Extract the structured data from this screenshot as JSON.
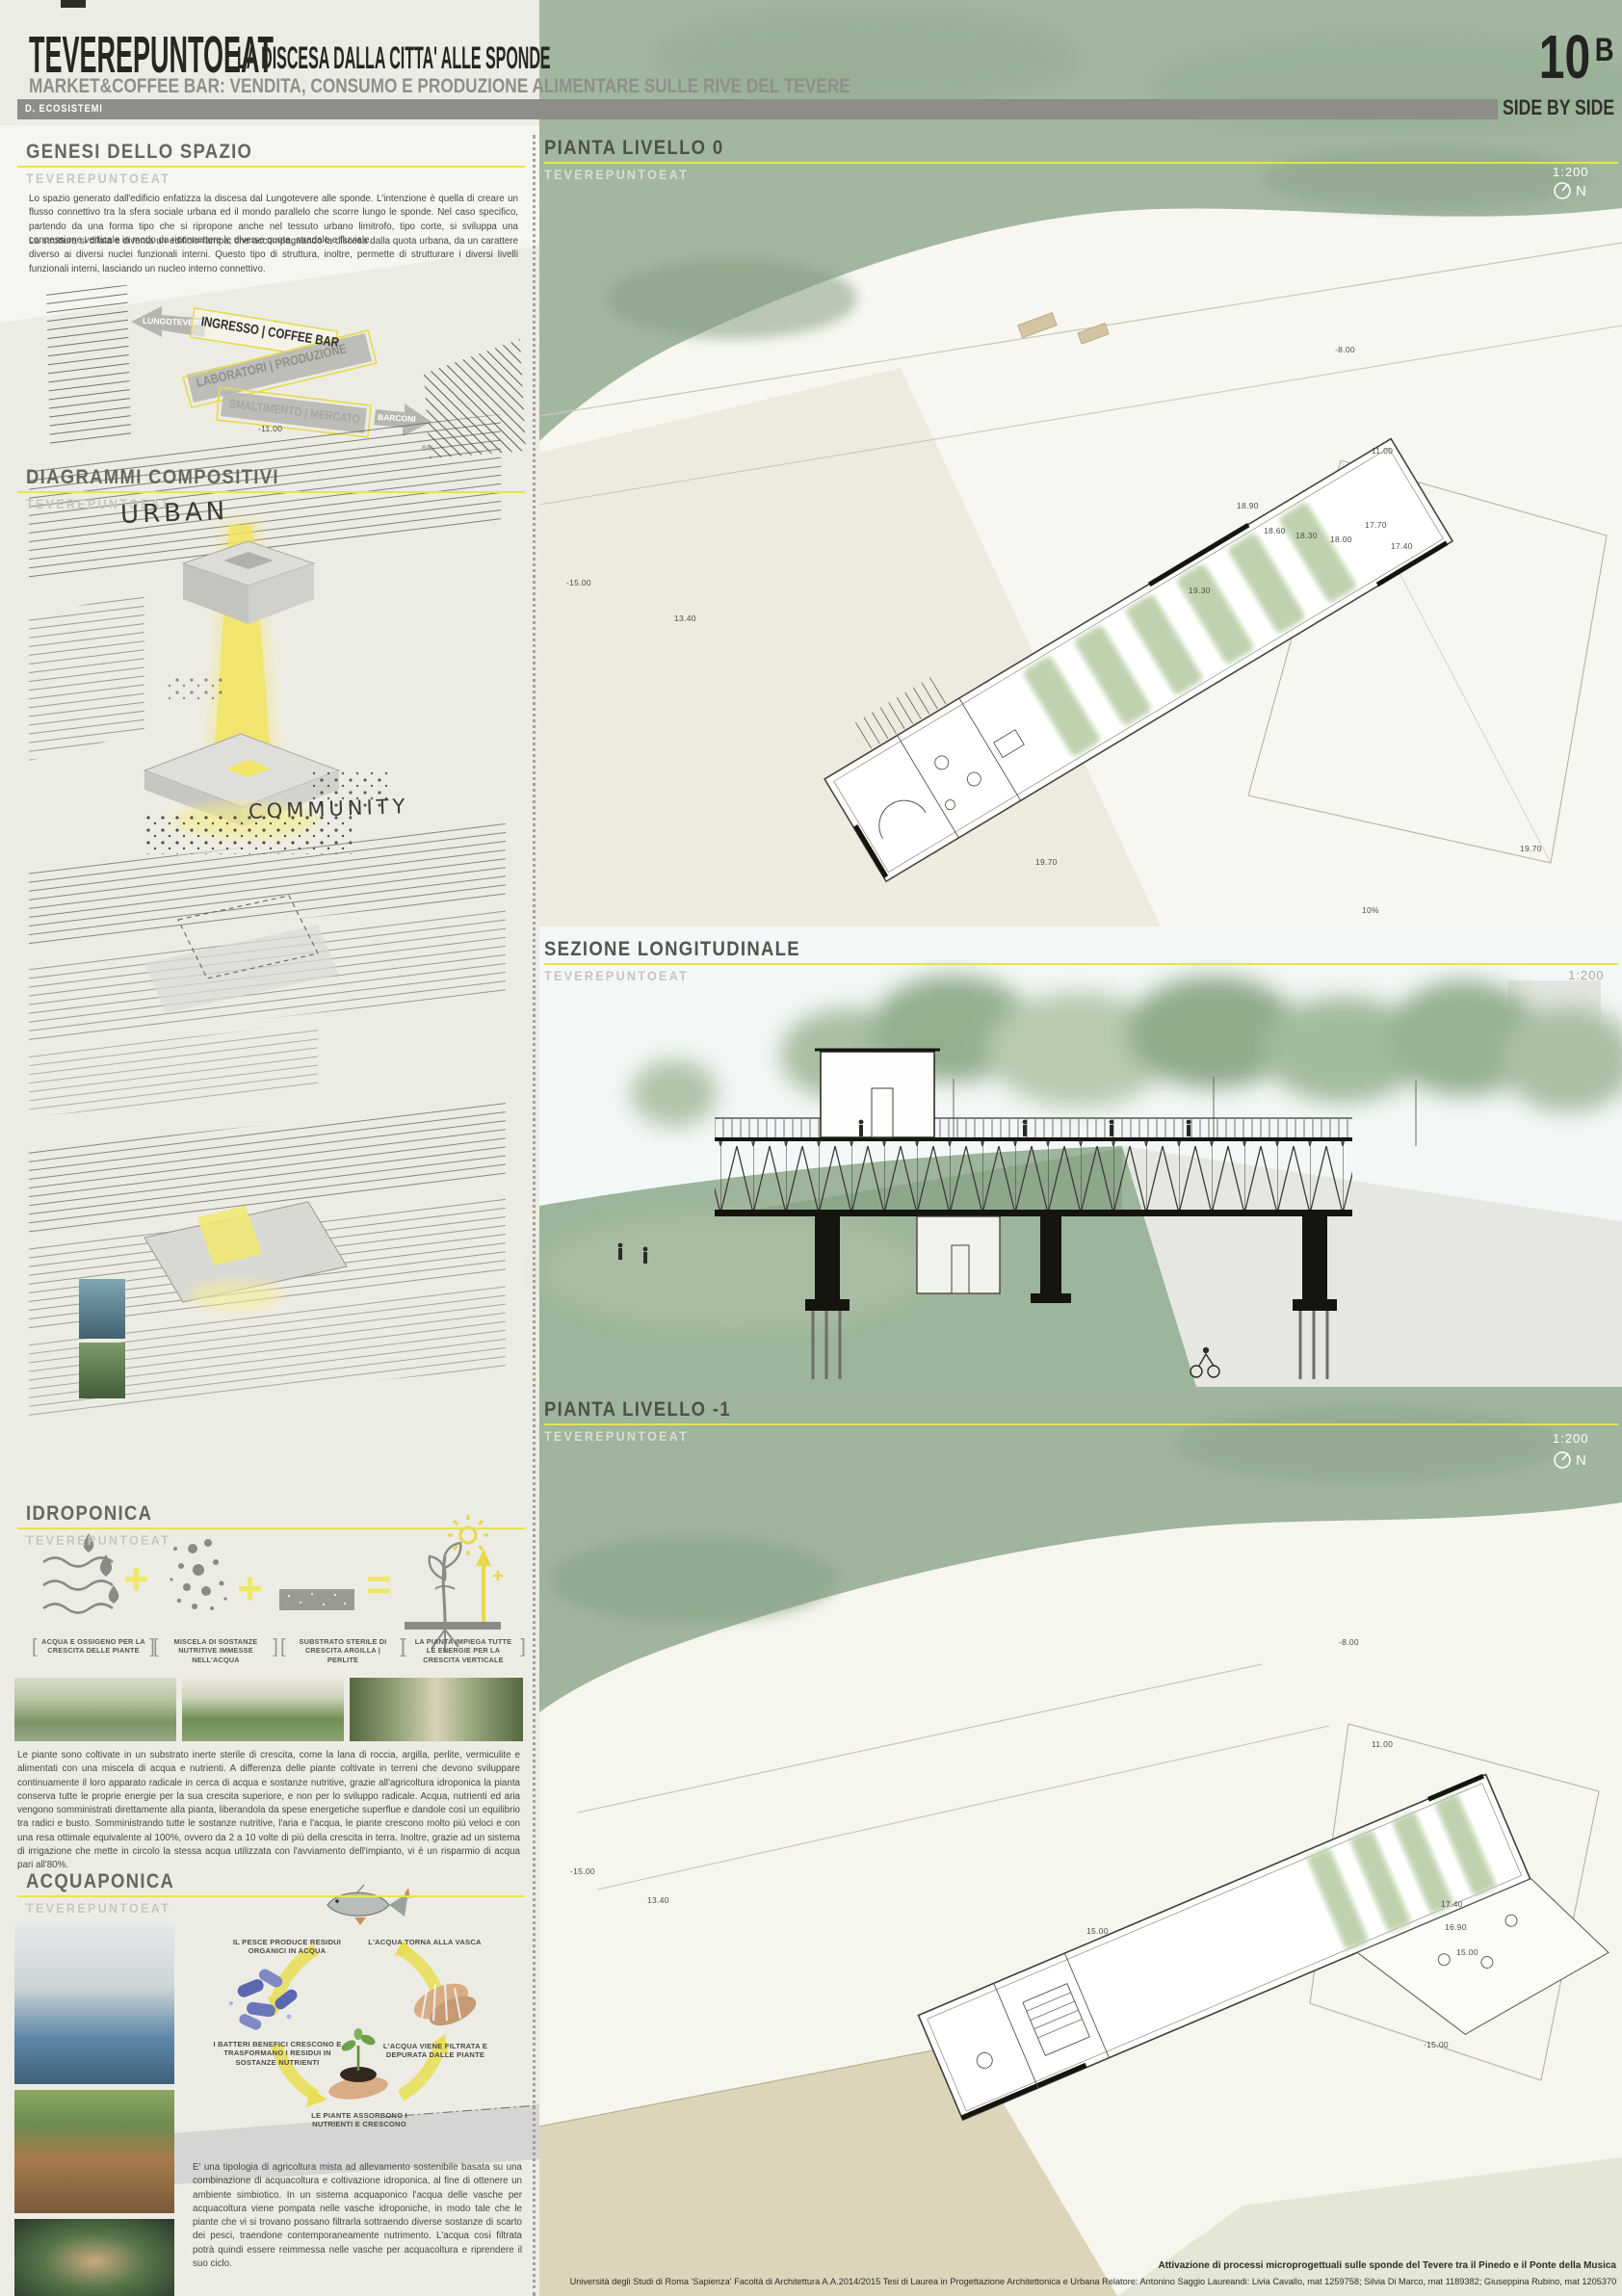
{
  "brand": "TEVEREPUNTOEAT",
  "header": {
    "title": "TEVEREPUNTOEAT",
    "subtitle": "LA DISCESA DALLA CITTA' ALLE SPONDE",
    "tagline": "MARKET&COFFEE BAR: VENDITA, CONSUMO E PRODUZIONE ALIMENTARE SULLE RIVE DEL TEVERE",
    "series_label": "D. ECOSISTEMI",
    "board_number": "10",
    "board_suffix": "B",
    "board_motto": "SIDE BY SIDE"
  },
  "genesi": {
    "title": "GENESI DELLO SPAZIO",
    "body1": "Lo spazio generato dall'edificio enfatizza la discesa dal Lungotevere alle sponde. L'intenzione è quella di creare un flusso connettivo tra la sfera sociale urbana ed il mondo parallelo che scorre lungo le sponde. Nel caso specifico, partendo da una forma tipo che si ripropone anche nel tessuto urbano limitrofo, tipo corte, si sviluppa una connessione verticale in modo da riconnettere le diverse quote, stradale e fluviale.",
    "body2": "La struttura si dilata e diventa un edificio-rampa, che accompagnando la discesa dalla quota urbana, da un carattere diverso ai diversi nuclei funzionali interni. Questo tipo di struttura, inoltre, permette di strutturare i diversi livelli funzionali interni, lasciando un nucleo interno connettivo."
  },
  "ramp": {
    "arrow_left": "LUNGOTEVERE",
    "strip1": "INGRESSO | COFFEE BAR",
    "strip2": "LABORATORI | PRODUZIONE",
    "strip3": "SMALTIMENTO | MERCATO",
    "arrow_right": "BARCONI",
    "quota": "-11.00",
    "slope": "6%"
  },
  "diagrammi": {
    "title": "DIAGRAMMI COMPOSITIVI",
    "label_urban": "URBAN",
    "label_community": "COMMUNITY"
  },
  "idroponica": {
    "title": "IDROPONICA",
    "op_plus": "+",
    "op_equals": "=",
    "formula": [
      {
        "icon": "water-oxygen-icon",
        "caption": "ACQUA E OSSIGENO PER LA CRESCITA DELLE PIANTE"
      },
      {
        "icon": "nutrient-mix-icon",
        "caption": "MISCELA DI SOSTANZE NUTRITIVE IMMESSE NELL'ACQUA"
      },
      {
        "icon": "substrate-icon",
        "caption": "SUBSTRATO STERILE DI CRESCITA ARGILLA | PERLITE"
      },
      {
        "icon": "vertical-growth-icon",
        "caption": "LA PIANTA IMPIEGA TUTTE LE ENERGIE PER LA CRESCITA VERTICALE"
      }
    ],
    "body": "Le piante sono coltivate in un substrato inerte sterile di crescita, come la lana di roccia, argilla, perlite, vermiculite e alimentati con una miscela di acqua e nutrienti. A differenza delle piante coltivate in terreni che devono sviluppare continuamente il loro apparato radicale in cerca di acqua e sostanze nutritive, grazie all'agricoltura idroponica la pianta conserva tutte le proprie energie per la sua crescita superiore, e non per lo sviluppo radicale. Acqua, nutrienti ed aria vengono somministrati direttamente alla pianta, liberandola da spese energetiche superflue e dandole così un equilibrio tra radici e busto. Somministrando tutte le sostanze nutritive, l'aria e l'acqua, le piante crescono molto più veloci e con una resa ottimale equivalente al 100%, ovvero da 2 a 10 volte di più della crescita in terra. Inoltre, grazie ad un sistema di irrigazione che mette in circolo la stessa acqua utilizzata con l'avviamento dell'impianto, vi è un risparmio di acqua pari all'80%."
  },
  "acquaponica": {
    "title": "ACQUAPONICA",
    "cycle": [
      {
        "label": "IL PESCE PRODUCE RESIDUI ORGANICI IN ACQUA"
      },
      {
        "label": "L'ACQUA TORNA ALLA VASCA"
      },
      {
        "label": "I BATTERI BENEFICI CRESCONO E TRASFORMANO I RESIDUI IN SOSTANZE NUTRIENTI"
      },
      {
        "label": "L'ACQUA VIENE FILTRATA E DEPURATA DALLE PIANTE"
      },
      {
        "label": "LE PIANTE ASSORBONO I NUTRIENTI E CRESCONO"
      }
    ],
    "body": "E' una tipologia di agricoltura mista ad allevamento sostenibile basata su una combinazione di acquacoltura e coltivazione idroponica, al fine di ottenere un ambiente simbiotico. In un sistema acquaponico l'acqua delle vasche per acquacoltura viene pompata nelle vasche idroponiche, in modo tale che le piante che vi si trovano possano filtrarla sottraendo diverse sostanze di scarto dei pesci, traendone contemporaneamente nutrimento. L'acqua così filtrata potrà quindi essere reimmessa nelle vasche per acquacoltura e riprendere il suo ciclo."
  },
  "panels": {
    "pianta0": {
      "title": "PIANTA LIVELLO 0",
      "scale": "1:200",
      "north": "N",
      "annotations": [
        {
          "t": "-8.00"
        },
        {
          "t": "11.00"
        },
        {
          "t": "18.90"
        },
        {
          "t": "18.60"
        },
        {
          "t": "18.30"
        },
        {
          "t": "18.00"
        },
        {
          "t": "17.70"
        },
        {
          "t": "17.40"
        },
        {
          "t": "19.30"
        },
        {
          "t": "13.40"
        },
        {
          "t": "-15.00"
        },
        {
          "t": "19.70"
        },
        {
          "t": "19.70"
        },
        {
          "t": "10%"
        }
      ]
    },
    "sezione": {
      "title": "SEZIONE LONGITUDINALE",
      "scale": "1:200"
    },
    "pianta_m1": {
      "title": "PIANTA LIVELLO -1",
      "scale": "1:200",
      "north": "N",
      "annotations": [
        {
          "t": "-8.00"
        },
        {
          "t": "11.00"
        },
        {
          "t": "13.40"
        },
        {
          "t": "-15.00"
        },
        {
          "t": "17.40"
        },
        {
          "t": "16.90"
        },
        {
          "t": "15.00"
        },
        {
          "t": "15.00"
        },
        {
          "t": "-15.00"
        }
      ]
    }
  },
  "footer": {
    "line1": "Attivazione di processi microprogettuali sulle sponde del Tevere tra il Pinedo e il Ponte della Musica",
    "line2": "Università degli Studi di Roma 'Sapienza'   Facoltà di Architettura   A.A.2014/2015  Tesi di Laurea in Progettazione Architettonica e Urbana  Relatore:  Antonino Saggio  Laureandi: Livia Cavallo, mat 1259758; Silvia Di Marco, mat 1189382; Giuseppina Rubino, mat 1205370"
  },
  "colors": {
    "accent_yellow": "#e9e34b",
    "watercolor_green": "#a2b7a0",
    "bar_gray": "#8d8d89",
    "ink": "#2b2b27"
  }
}
